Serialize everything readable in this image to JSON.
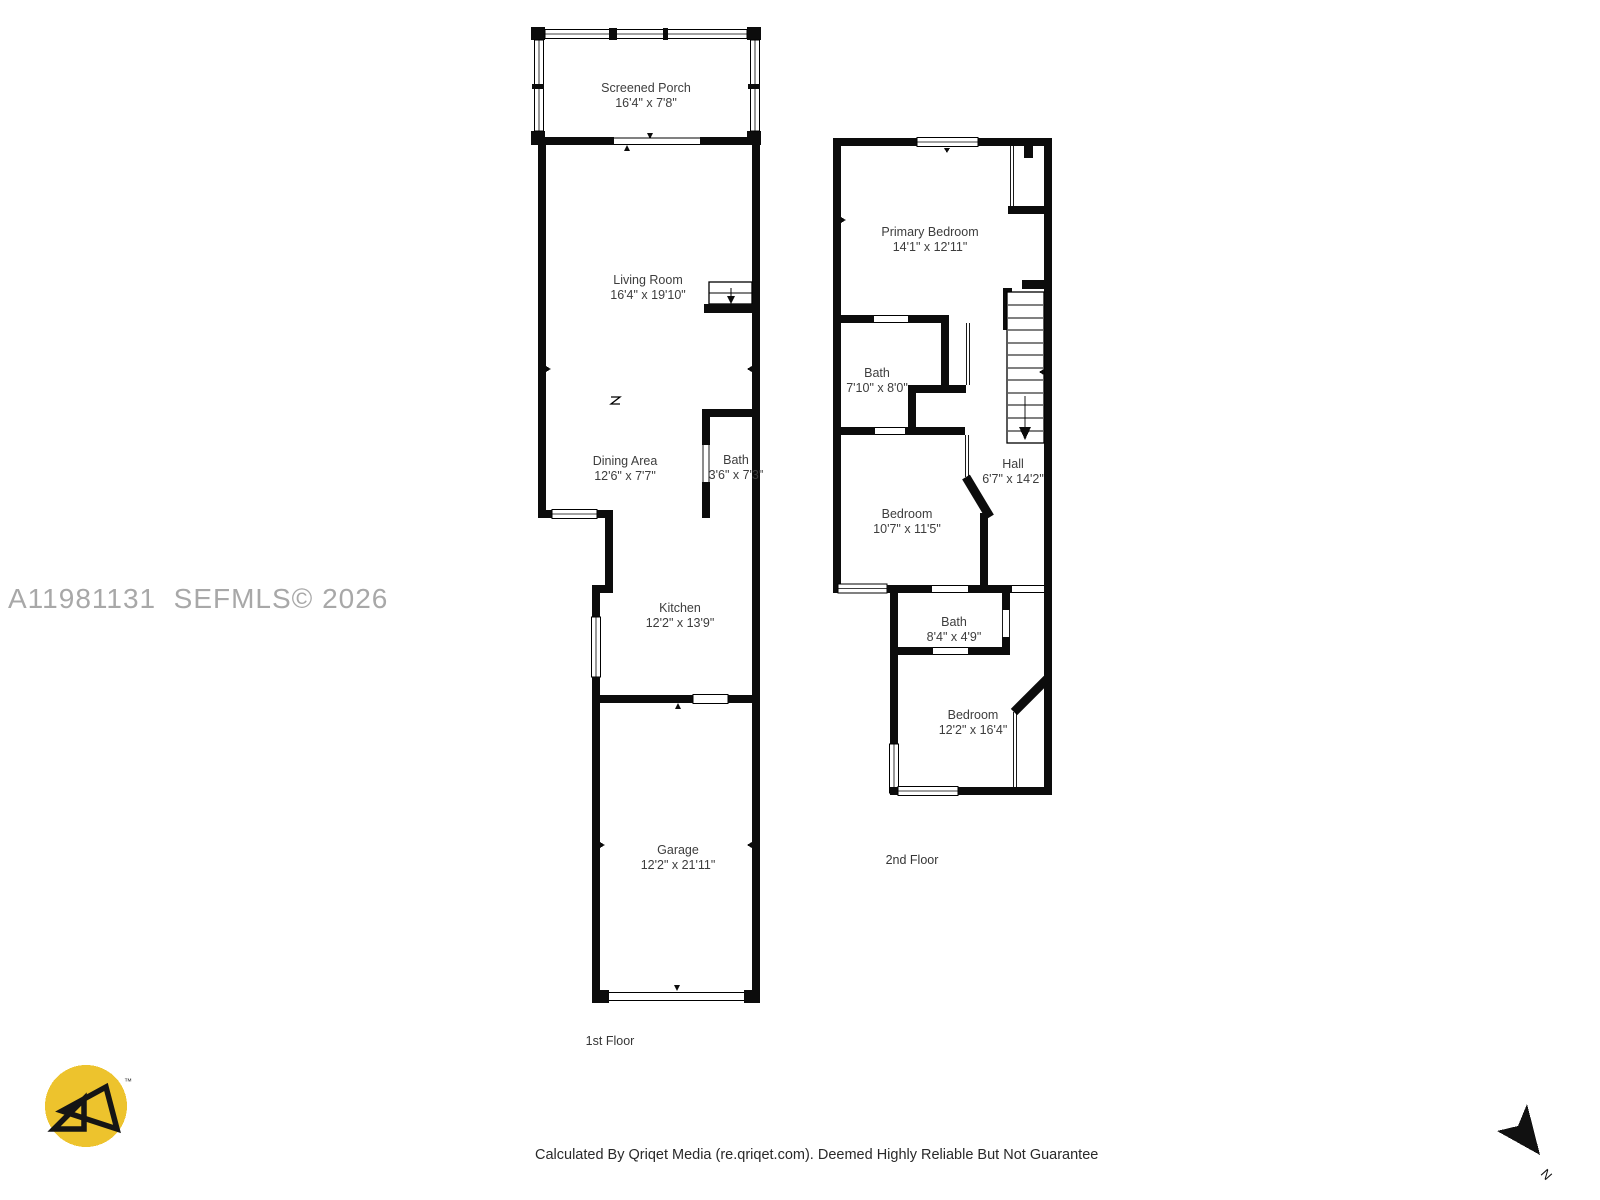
{
  "watermark": "A11981131  SEFMLS© 2026",
  "footer": "Calculated By Qriqet Media (re.qriqet.com). Deemed Highly Reliable But Not Guarantee",
  "compass_label": "N",
  "logo_tm": "™",
  "floor1": {
    "label": "1st Floor",
    "rooms": [
      {
        "name": "Screened Porch",
        "dims": "16'4\" x 7'8\""
      },
      {
        "name": "Living Room",
        "dims": "16'4\" x 19'10\""
      },
      {
        "name": "Dining Area",
        "dims": "12'6\" x 7'7\""
      },
      {
        "name": "Bath",
        "dims": "3'6\" x 7'3\""
      },
      {
        "name": "Kitchen",
        "dims": "12'2\" x 13'9\""
      },
      {
        "name": "Garage",
        "dims": "12'2\" x 21'11\""
      }
    ]
  },
  "floor2": {
    "label": "2nd Floor",
    "rooms": [
      {
        "name": "Primary Bedroom",
        "dims": "14'1\" x 12'11\""
      },
      {
        "name": "Bath",
        "dims": "7'10\" x 8'0\""
      },
      {
        "name": "Hall",
        "dims": "6'7\" x 14'2\""
      },
      {
        "name": "Bedroom",
        "dims": "10'7\" x 11'5\""
      },
      {
        "name": "Bath",
        "dims": "8'4\" x 4'9\""
      },
      {
        "name": "Bedroom",
        "dims": "12'2\" x 16'4\""
      }
    ]
  },
  "colors": {
    "wall": "#0c0c0c",
    "logo_yellow": "#edc32d",
    "watermark_gray": "#a8a8a8"
  }
}
